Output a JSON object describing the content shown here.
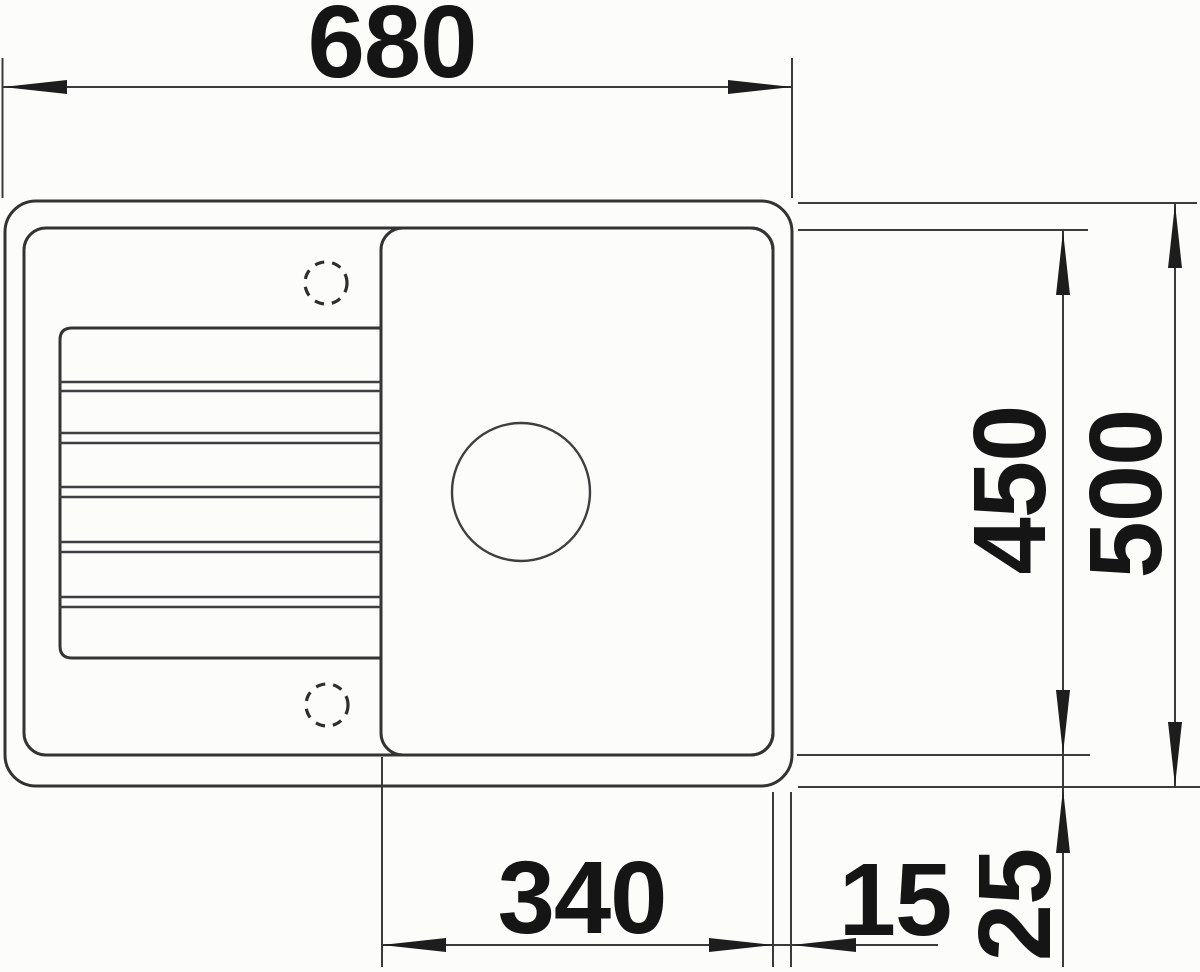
{
  "drawing": {
    "kind": "sink-top-view-dimension-drawing",
    "dimensions": {
      "width_overall": "680",
      "depth_overall": "500",
      "depth_bowl": "450",
      "width_bowl": "340",
      "edge_gap_right": "15",
      "edge_gap_bottom": "25"
    },
    "colors": {
      "line": "#3b3b3b",
      "outline": "#333333",
      "text": "#151515",
      "background": "#fcfcfb"
    }
  }
}
